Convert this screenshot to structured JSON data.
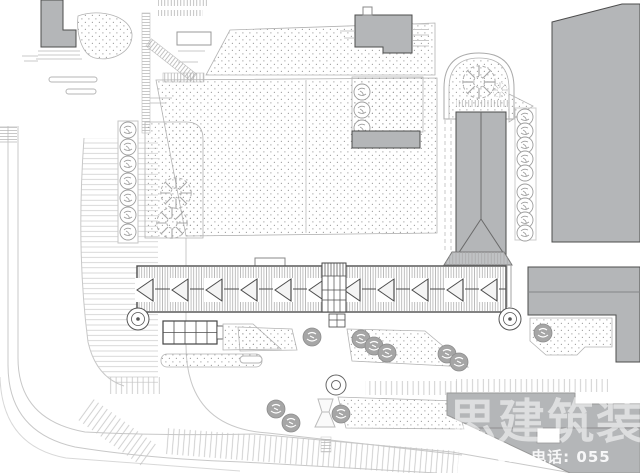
{
  "watermark": {
    "large_text": "思建筑装",
    "small_text": "om 电话: 055"
  },
  "colors": {
    "background": "#ffffff",
    "building_fill": "#b4b6b8",
    "building_outline": "#4d4d4d",
    "line_light": "#c8c8c8",
    "line_medium": "#9a9a9a",
    "bed_outline": "#b3b3b3",
    "stipple_dot": "#9b9b9b",
    "tree_fill": "#a6a6a6",
    "tree_outline": "#8c8c8c",
    "watermark_color": "#ffffff"
  }
}
